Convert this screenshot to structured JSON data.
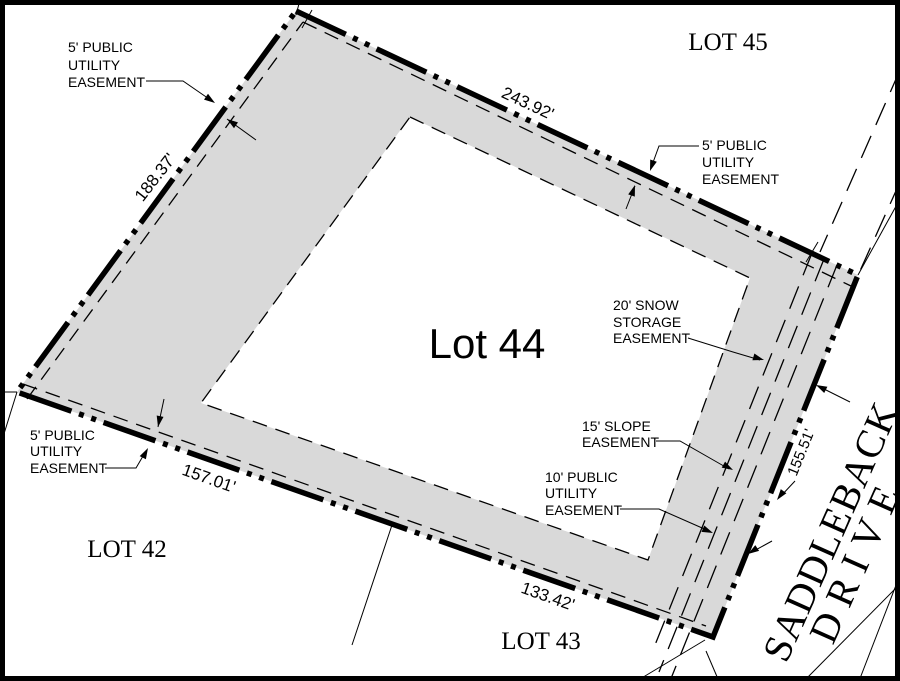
{
  "parcel": {
    "label": "Lot 44"
  },
  "adjacent_lots": {
    "lot45": "LOT 45",
    "lot42": "LOT 42",
    "lot43": "LOT 43"
  },
  "street": {
    "name_line1": "SADDLEBACK",
    "name_line2": "DRIVE"
  },
  "dimensions": {
    "north": "243.92'",
    "west": "188.37'",
    "south_west": "157.01'",
    "south_east": "133.42'",
    "east": "155.51'"
  },
  "easement_labels": {
    "pue_nw": {
      "lines": [
        "5' PUBLIC",
        "UTILITY",
        "EASEMENT"
      ]
    },
    "pue_ne": {
      "lines": [
        "5' PUBLIC",
        "UTILITY",
        "EASEMENT"
      ]
    },
    "pue_sw": {
      "lines": [
        "5' PUBLIC",
        "UTILITY",
        "EASEMENT"
      ]
    },
    "snow_storage": {
      "lines": [
        "20' SNOW",
        "STORAGE",
        "EASEMENT"
      ]
    },
    "slope": {
      "lines": [
        "15' SLOPE",
        "EASEMENT"
      ]
    },
    "pue_se": {
      "lines": [
        "10' PUBLIC",
        "UTILITY",
        "EASEMENT"
      ]
    }
  },
  "colors": {
    "easement_fill": "#d9d9d9",
    "line": "#000000",
    "background": "#ffffff"
  }
}
